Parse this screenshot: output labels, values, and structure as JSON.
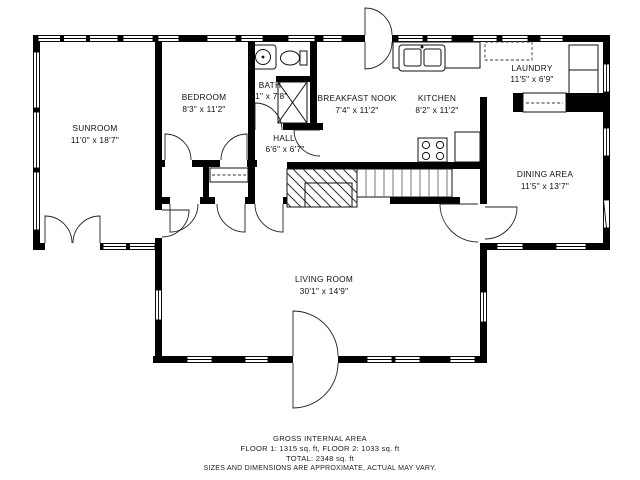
{
  "plan": {
    "rooms": [
      {
        "id": "sunroom",
        "name": "SUNROOM",
        "dims": "11'0\" x 18'7\""
      },
      {
        "id": "bedroom",
        "name": "BEDROOM",
        "dims": "8'3\" x 11'2\""
      },
      {
        "id": "bath",
        "name": "BATH",
        "dims": "5'1\" x 7'8\""
      },
      {
        "id": "breakfast-nook",
        "name": "BREAKFAST NOOK",
        "dims": "7'4\" x 11'2\""
      },
      {
        "id": "kitchen",
        "name": "KITCHEN",
        "dims": "8'2\" x 11'2\""
      },
      {
        "id": "laundry",
        "name": "LAUNDRY",
        "dims": "11'5\" x 6'9\""
      },
      {
        "id": "hall",
        "name": "HALL",
        "dims": "6'6\" x 6'7\""
      },
      {
        "id": "dining",
        "name": "DINING AREA",
        "dims": "11'5\" x 13'7\""
      },
      {
        "id": "living",
        "name": "LIVING ROOM",
        "dims": "30'1\" x 14'9\""
      }
    ],
    "fixtures": [
      "bath-sink",
      "toilet",
      "shower",
      "kitchen-sink",
      "stove",
      "washer-dryer",
      "laundry-counter",
      "stairs",
      "fireplace",
      "wardrobe"
    ],
    "colors": {
      "wall": "#000000",
      "background": "#ffffff",
      "line": "#222222"
    }
  },
  "footer": {
    "line1": "GROSS INTERNAL AREA",
    "line2": "FLOOR 1: 1315 sq. ft, FLOOR 2: 1033 sq. ft",
    "line3": "TOTAL: 2348 sq. ft",
    "line4": "SIZES AND DIMENSIONS ARE APPROXIMATE, ACTUAL MAY VARY."
  }
}
